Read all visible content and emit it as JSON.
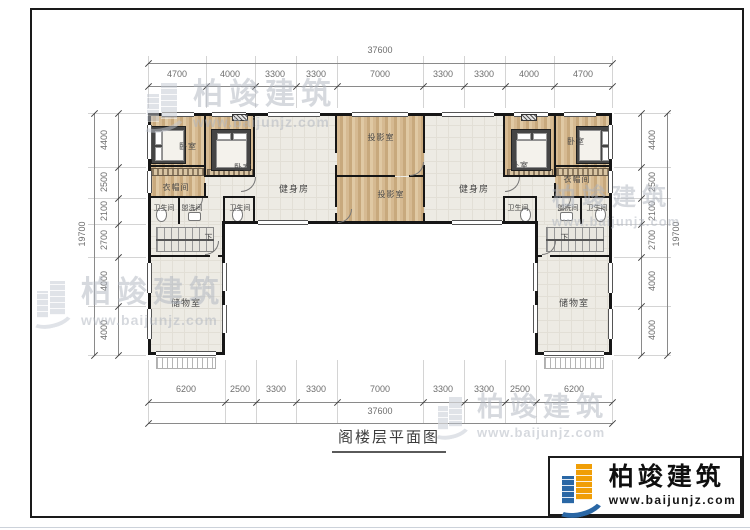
{
  "title": "阁楼层平面图",
  "logo": {
    "name": "柏竣建筑",
    "url": "www.baijunjz.com"
  },
  "watermark": {
    "name": "柏竣建筑",
    "url": "www.baijunjz.com"
  },
  "dims": {
    "top_total": "37600",
    "bottom_total": "37600",
    "side_total": "19700",
    "top_segments": [
      "4700",
      "4000",
      "3300",
      "3300",
      "7000",
      "3300",
      "3300",
      "4000",
      "4700"
    ],
    "bottom_segments": [
      "6200",
      "2500",
      "3300",
      "3300",
      "7000",
      "3300",
      "3300",
      "2500",
      "6200"
    ],
    "side_segments": [
      "4400",
      "2500",
      "2100",
      "2700",
      "4000",
      "4000"
    ]
  },
  "rooms": {
    "bedroom_l1": "卧室",
    "bedroom_l2": "卧室",
    "closet_l": "衣帽间",
    "bath_l": "卫生间",
    "wash_l": "盥洗间",
    "bath_l2": "卫生间",
    "gym_l": "健身房",
    "projection_top": "投影室",
    "projection_bottom": "投影室",
    "gym_r": "健身房",
    "bedroom_r1": "卧室",
    "bedroom_r2": "卧室",
    "closet_r": "衣帽间",
    "bath_r2": "卫生间",
    "wash_r": "盥洗间",
    "bath_r": "卫生间",
    "stairs_l": "下",
    "stairs_r": "下",
    "storage_l": "储物室",
    "storage_r": "储物室"
  }
}
